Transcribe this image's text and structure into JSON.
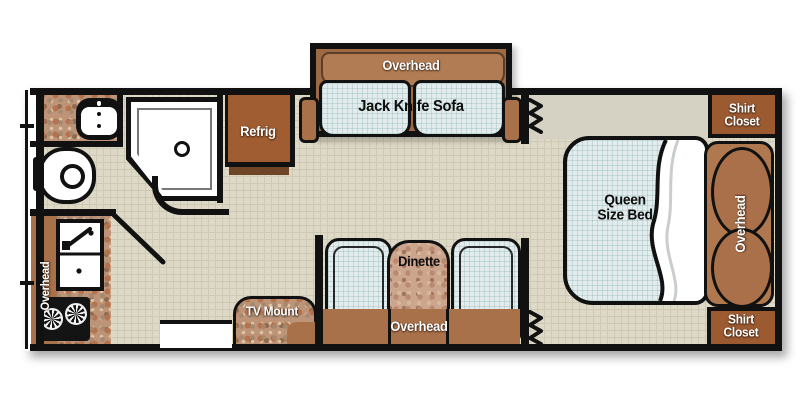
{
  "floorplan": {
    "type": "travel-trailer-floorplan",
    "areas": {
      "living": {
        "sofa_overhead": "Overhead",
        "sofa": "Jack Knife Sofa",
        "refrigerator": "Refrig",
        "tv_mount": "TV Mount"
      },
      "kitchen": {
        "overhead": "Overhead"
      },
      "dinette": {
        "name": "Dinette",
        "overhead": "Overhead"
      },
      "bedroom": {
        "bed_line1": "Queen",
        "bed_line2": "Size Bed",
        "overhead": "Overhead",
        "shirt_closet_top": "Shirt Closet",
        "shirt_closet_bottom": "Shirt Closet"
      }
    },
    "colors": {
      "wall": "#111111",
      "floor": "#ded9c6",
      "cushion": "#e3ecec",
      "wood_light": "#b17c54",
      "wood_mid": "#a9714a",
      "wood_dark": "#9c5a31",
      "refrigerator": "#a05d31"
    }
  }
}
